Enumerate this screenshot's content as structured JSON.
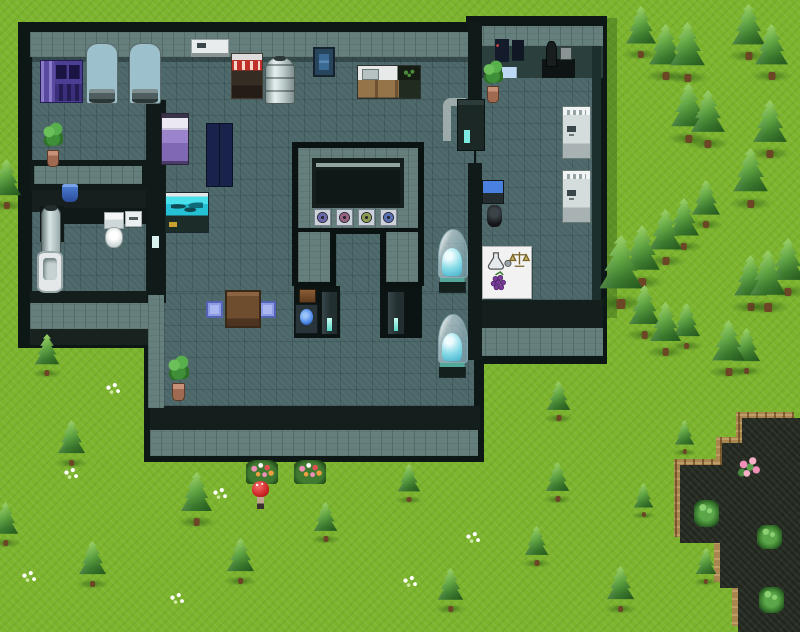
{
  "meta": {
    "scene": "rpg-laboratory-map",
    "canvas": {
      "w": 800,
      "h": 632
    }
  },
  "palette": {
    "grass": "#7cb42e",
    "stone": "#647f7c",
    "floor": "#4b6668",
    "outline": "#0d1716",
    "pond": "#2a3027",
    "pond_rim": "#a9854f",
    "tree_light": "#9ad063",
    "tree_dark": "#2b6125",
    "capsule_water": "#8adce8",
    "aquarium": "#25c2d6",
    "accent_cyan": "#7ce8e0"
  },
  "terrain": {
    "shadows": [
      {
        "name": "wing-east-grass-shadow",
        "x": 607,
        "y": 18,
        "w": 10,
        "h": 300
      }
    ],
    "pond": {
      "rim_offset": -6,
      "points": [
        [
          742,
          418
        ],
        [
          800,
          418
        ],
        [
          800,
          632
        ],
        [
          738,
          632
        ],
        [
          738,
          588
        ],
        [
          720,
          588
        ],
        [
          720,
          543
        ],
        [
          680,
          543
        ],
        [
          680,
          465
        ],
        [
          722,
          465
        ],
        [
          722,
          443
        ],
        [
          742,
          443
        ]
      ]
    }
  },
  "building": {
    "pieces": [
      {
        "n": "outline-main",
        "c": "#0d1716",
        "x": 18,
        "y": 22,
        "w": 460,
        "h": 326
      },
      {
        "n": "outline-wing",
        "c": "#0d1716",
        "x": 466,
        "y": 16,
        "w": 141,
        "h": 348
      },
      {
        "n": "outline-lower",
        "c": "#0d1716",
        "x": 144,
        "y": 291,
        "w": 340,
        "h": 171
      },
      {
        "n": "stone-band-top-main",
        "cls": "stone",
        "x": 30,
        "y": 32,
        "w": 444,
        "h": 25
      },
      {
        "n": "stone-band-top-wing",
        "cls": "stone",
        "x": 472,
        "y": 26,
        "w": 131,
        "h": 20
      },
      {
        "n": "floor-main-hall",
        "cls": "floor",
        "x": 32,
        "y": 57,
        "w": 442,
        "h": 235
      },
      {
        "n": "floor-lower-hall",
        "cls": "floor",
        "x": 164,
        "y": 292,
        "w": 310,
        "h": 114
      },
      {
        "n": "floor-right-wing",
        "cls": "floor",
        "x": 476,
        "y": 78,
        "w": 118,
        "h": 222
      },
      {
        "n": "wall-shadow-main",
        "c": "rgba(8,18,18,.35)",
        "x": 32,
        "y": 57,
        "w": 442,
        "h": 5
      },
      {
        "n": "wing-north-wall-face",
        "c": "#2b403d",
        "x": 476,
        "y": 46,
        "w": 127,
        "h": 32
      },
      {
        "n": "wing-east-wall",
        "c": "#1d2f2c",
        "x": 592,
        "y": 46,
        "w": 9,
        "h": 254
      },
      {
        "n": "bottom-wall-dark-main",
        "c": "#141e1c",
        "x": 150,
        "y": 406,
        "w": 330,
        "h": 24
      },
      {
        "n": "bottom-wall-stone-main",
        "cls": "stone",
        "x": 150,
        "y": 430,
        "w": 328,
        "h": 26
      },
      {
        "n": "bottom-wall-dark-wing",
        "c": "#141e1c",
        "x": 474,
        "y": 300,
        "w": 129,
        "h": 28
      },
      {
        "n": "bottom-wall-stone-wing",
        "cls": "stone",
        "x": 474,
        "y": 328,
        "w": 129,
        "h": 28
      },
      {
        "n": "bottom-wall-dark-left",
        "c": "#141e1c",
        "x": 30,
        "y": 291,
        "w": 128,
        "h": 12
      },
      {
        "n": "bottom-wall-stone-left",
        "cls": "stone",
        "x": 30,
        "y": 303,
        "w": 128,
        "h": 26
      },
      {
        "n": "bottom-apron-left",
        "c": "#18221f",
        "x": 30,
        "y": 329,
        "w": 128,
        "h": 16
      },
      {
        "n": "wall-divider-horizontal",
        "c": "#101b19",
        "x": 30,
        "y": 160,
        "w": 116,
        "h": 30
      },
      {
        "n": "wall-divider-horizontal-core",
        "cls": "stone",
        "x": 34,
        "y": 166,
        "w": 108,
        "h": 18
      },
      {
        "n": "wall-vertical-west",
        "c": "#101b19",
        "x": 146,
        "y": 100,
        "w": 20,
        "h": 203
      },
      {
        "n": "wall-vertical-west-lower",
        "cls": "stone",
        "x": 148,
        "y": 295,
        "w": 16,
        "h": 113
      },
      {
        "n": "wall-divider-wing-upper",
        "c": "#101b19",
        "x": 468,
        "y": 22,
        "w": 14,
        "h": 78
      },
      {
        "n": "wall-divider-wing-lower",
        "c": "#101b19",
        "x": 468,
        "y": 163,
        "w": 14,
        "h": 197
      },
      {
        "n": "bath-north-wall-face",
        "c": "#161f1d",
        "x": 32,
        "y": 190,
        "w": 114,
        "h": 22
      },
      {
        "n": "bath-counter",
        "c": "#101918",
        "x": 50,
        "y": 208,
        "w": 98,
        "h": 16
      },
      {
        "n": "shower-backdrop",
        "c": "#101918",
        "x": 40,
        "y": 206,
        "w": 24,
        "h": 36
      },
      {
        "n": "wall-light-slot",
        "c": "#d8f0ee",
        "x": 152,
        "y": 236,
        "w": 7,
        "h": 12
      },
      {
        "n": "chamber-outline",
        "c": "#0a1312",
        "x": 292,
        "y": 142,
        "w": 132,
        "h": 92
      },
      {
        "n": "chamber-stone-ring",
        "cls": "stone",
        "x": 298,
        "y": 148,
        "w": 120,
        "h": 80
      },
      {
        "n": "chamber-panel",
        "c": "#141f1e",
        "x": 312,
        "y": 158,
        "w": 92,
        "h": 50
      },
      {
        "n": "chamber-panel-line",
        "c": "#93a3a1",
        "x": 316,
        "y": 163,
        "w": 84,
        "h": 4
      },
      {
        "n": "chamber-screen",
        "c": "#0e1817",
        "x": 316,
        "y": 170,
        "w": 84,
        "h": 34
      },
      {
        "n": "chamber-leg-left",
        "c": "#0a1312",
        "x": 292,
        "y": 228,
        "w": 44,
        "h": 58
      },
      {
        "n": "chamber-leg-left-core",
        "cls": "stone",
        "x": 298,
        "y": 232,
        "w": 32,
        "h": 50
      },
      {
        "n": "chamber-leg-right",
        "c": "#0a1312",
        "x": 380,
        "y": 228,
        "w": 44,
        "h": 58
      },
      {
        "n": "chamber-leg-right-core",
        "cls": "stone",
        "x": 386,
        "y": 232,
        "w": 32,
        "h": 50
      },
      {
        "n": "alcove-left",
        "c": "#0b1413",
        "x": 294,
        "y": 286,
        "w": 46,
        "h": 52
      },
      {
        "n": "alcove-right",
        "c": "#0b1413",
        "x": 380,
        "y": 286,
        "w": 42,
        "h": 52
      }
    ],
    "emblems": [
      {
        "x": 314,
        "y": 209,
        "color": "#6868a8"
      },
      {
        "x": 336,
        "y": 209,
        "color": "#96627e"
      },
      {
        "x": 358,
        "y": 209,
        "color": "#8c9a52"
      },
      {
        "x": 380,
        "y": 209,
        "color": "#5870b0"
      }
    ]
  },
  "sprites": [
    {
      "t": "purple-console",
      "x": 40,
      "y": 60,
      "w": 43,
      "h": 43
    },
    {
      "t": "water-tank",
      "x": 86,
      "y": 43,
      "w": 32,
      "h": 61
    },
    {
      "t": "water-tank",
      "x": 129,
      "y": 43,
      "w": 32,
      "h": 61
    },
    {
      "t": "vent-white",
      "x": 191,
      "y": 39,
      "w": 38,
      "h": 18
    },
    {
      "t": "shelf-red",
      "x": 231,
      "y": 53,
      "w": 32,
      "h": 46
    },
    {
      "t": "boiler",
      "x": 265,
      "y": 57,
      "w": 30,
      "h": 47
    },
    {
      "t": "poster-blue",
      "x": 313,
      "y": 47,
      "w": 22,
      "h": 30
    },
    {
      "t": "kitchen-counter",
      "x": 357,
      "y": 65,
      "w": 64,
      "h": 34
    },
    {
      "t": "plant-pot",
      "x": 43,
      "y": 122,
      "w": 20,
      "h": 45
    },
    {
      "t": "bed-purple",
      "x": 161,
      "y": 113,
      "w": 28,
      "h": 52
    },
    {
      "t": "locker-blue",
      "x": 206,
      "y": 123,
      "w": 27,
      "h": 64
    },
    {
      "t": "pail-blue",
      "x": 62,
      "y": 184,
      "w": 16,
      "h": 18
    },
    {
      "t": "aquarium",
      "x": 165,
      "y": 192,
      "w": 44,
      "h": 41
    },
    {
      "t": "shower-column",
      "x": 41,
      "y": 206,
      "w": 20,
      "h": 47
    },
    {
      "t": "bathtub",
      "x": 37,
      "y": 251,
      "w": 26,
      "h": 42
    },
    {
      "t": "toilet",
      "x": 103,
      "y": 212,
      "w": 20,
      "h": 36
    },
    {
      "t": "dispenser",
      "x": 125,
      "y": 211,
      "w": 17,
      "h": 16
    },
    {
      "t": "pipe-machine",
      "x": 441,
      "y": 96,
      "w": 44,
      "h": 53
    },
    {
      "t": "plant-pot",
      "x": 483,
      "y": 60,
      "w": 20,
      "h": 43
    },
    {
      "t": "poster-cluster",
      "x": 495,
      "y": 39,
      "w": 32,
      "h": 40
    },
    {
      "t": "lab-desk",
      "x": 542,
      "y": 41,
      "w": 33,
      "h": 37
    },
    {
      "t": "console-white",
      "x": 562,
      "y": 106,
      "w": 29,
      "h": 53
    },
    {
      "t": "console-white",
      "x": 562,
      "y": 170,
      "w": 29,
      "h": 53
    },
    {
      "t": "office-desk",
      "x": 482,
      "y": 180,
      "w": 26,
      "h": 47
    },
    {
      "t": "capsule",
      "x": 438,
      "y": 229,
      "w": 28,
      "h": 64
    },
    {
      "t": "capsule",
      "x": 438,
      "y": 314,
      "w": 28,
      "h": 64
    },
    {
      "t": "sign-white",
      "x": 482,
      "y": 246,
      "w": 50,
      "h": 53
    },
    {
      "t": "shelf-brown-small",
      "x": 299,
      "y": 289,
      "w": 17,
      "h": 14
    },
    {
      "t": "hall-computer",
      "x": 295,
      "y": 304,
      "w": 23,
      "h": 30
    },
    {
      "t": "door-terminal",
      "x": 321,
      "y": 291,
      "w": 17,
      "h": 44
    },
    {
      "t": "door-terminal",
      "x": 387,
      "y": 291,
      "w": 18,
      "h": 44
    },
    {
      "t": "table-brown",
      "x": 225,
      "y": 290,
      "w": 36,
      "h": 38
    },
    {
      "t": "cushion-blue",
      "x": 206,
      "y": 301,
      "w": 17,
      "h": 17
    },
    {
      "t": "cushion-blue",
      "x": 259,
      "y": 301,
      "w": 17,
      "h": 17
    },
    {
      "t": "paper-blue",
      "x": 262,
      "y": 305,
      "w": 11,
      "h": 12
    },
    {
      "t": "plant-pot",
      "x": 168,
      "y": 355,
      "w": 21,
      "h": 46
    },
    {
      "t": "red-npc",
      "x": 252,
      "y": 481,
      "w": 17,
      "h": 28
    },
    {
      "t": "flower-bed",
      "x": 246,
      "y": 460,
      "w": 32,
      "h": 24
    },
    {
      "t": "flower-bed",
      "x": 294,
      "y": 460,
      "w": 32,
      "h": 24
    },
    {
      "t": "pink-flowers",
      "x": 736,
      "y": 455,
      "w": 27,
      "h": 27
    },
    {
      "t": "green-bush",
      "x": 694,
      "y": 500,
      "w": 25,
      "h": 27
    },
    {
      "t": "green-bush",
      "x": 757,
      "y": 525,
      "w": 25,
      "h": 24
    },
    {
      "t": "green-bush",
      "x": 759,
      "y": 587,
      "w": 25,
      "h": 26
    },
    {
      "t": "white-flowers",
      "x": 104,
      "y": 382,
      "w": 18,
      "h": 14
    },
    {
      "t": "white-flowers",
      "x": 62,
      "y": 467,
      "w": 18,
      "h": 14
    },
    {
      "t": "white-flowers",
      "x": 20,
      "y": 570,
      "w": 18,
      "h": 14
    },
    {
      "t": "white-flowers",
      "x": 168,
      "y": 592,
      "w": 18,
      "h": 14
    },
    {
      "t": "white-flowers",
      "x": 211,
      "y": 487,
      "w": 18,
      "h": 14
    },
    {
      "t": "white-flowers",
      "x": 464,
      "y": 531,
      "w": 18,
      "h": 14
    },
    {
      "t": "white-flowers",
      "x": 401,
      "y": 575,
      "w": 18,
      "h": 14
    }
  ],
  "sign_icons": [
    "flask",
    "mortar",
    "scale",
    "grapes"
  ],
  "interactable_types": [
    "red-npc",
    "sign-white",
    "hall-computer",
    "door-terminal"
  ],
  "trees": [
    {
      "cx": 641,
      "base": 58,
      "h": 52
    },
    {
      "cx": 665,
      "base": 80,
      "h": 56
    },
    {
      "cx": 687,
      "base": 82,
      "h": 60
    },
    {
      "cx": 748,
      "base": 60,
      "h": 56
    },
    {
      "cx": 771,
      "base": 80,
      "h": 56
    },
    {
      "cx": 688,
      "base": 143,
      "h": 60
    },
    {
      "cx": 708,
      "base": 148,
      "h": 58
    },
    {
      "cx": 770,
      "base": 158,
      "h": 58
    },
    {
      "cx": 750,
      "base": 208,
      "h": 60
    },
    {
      "cx": 706,
      "base": 228,
      "h": 48
    },
    {
      "cx": 684,
      "base": 250,
      "h": 52
    },
    {
      "cx": 665,
      "base": 265,
      "h": 56
    },
    {
      "cx": 642,
      "base": 287,
      "h": 62
    },
    {
      "cx": 621,
      "base": 309,
      "h": 74
    },
    {
      "cx": 768,
      "base": 312,
      "h": 62
    },
    {
      "cx": 788,
      "base": 296,
      "h": 58
    },
    {
      "cx": 750,
      "base": 311,
      "h": 56
    },
    {
      "cx": 644,
      "base": 339,
      "h": 54
    },
    {
      "cx": 665,
      "base": 356,
      "h": 54
    },
    {
      "cx": 686,
      "base": 349,
      "h": 46
    },
    {
      "cx": 728,
      "base": 376,
      "h": 56
    },
    {
      "cx": 746,
      "base": 374,
      "h": 46
    },
    {
      "cx": 6,
      "base": 209,
      "h": 50
    },
    {
      "cx": 47,
      "base": 376,
      "h": 42
    },
    {
      "cx": 71,
      "base": 466,
      "h": 46
    },
    {
      "cx": 5,
      "base": 546,
      "h": 44
    },
    {
      "cx": 92,
      "base": 587,
      "h": 46
    },
    {
      "cx": 196,
      "base": 526,
      "h": 54
    },
    {
      "cx": 240,
      "base": 584,
      "h": 46
    },
    {
      "cx": 325,
      "base": 542,
      "h": 40
    },
    {
      "cx": 409,
      "base": 502,
      "h": 38
    },
    {
      "cx": 450,
      "base": 612,
      "h": 44
    },
    {
      "cx": 536,
      "base": 566,
      "h": 40
    },
    {
      "cx": 557,
      "base": 502,
      "h": 40
    },
    {
      "cx": 558,
      "base": 421,
      "h": 40
    },
    {
      "cx": 620,
      "base": 612,
      "h": 46
    },
    {
      "cx": 684,
      "base": 454,
      "h": 34
    },
    {
      "cx": 643,
      "base": 517,
      "h": 34
    },
    {
      "cx": 706,
      "base": 584,
      "h": 36
    }
  ]
}
